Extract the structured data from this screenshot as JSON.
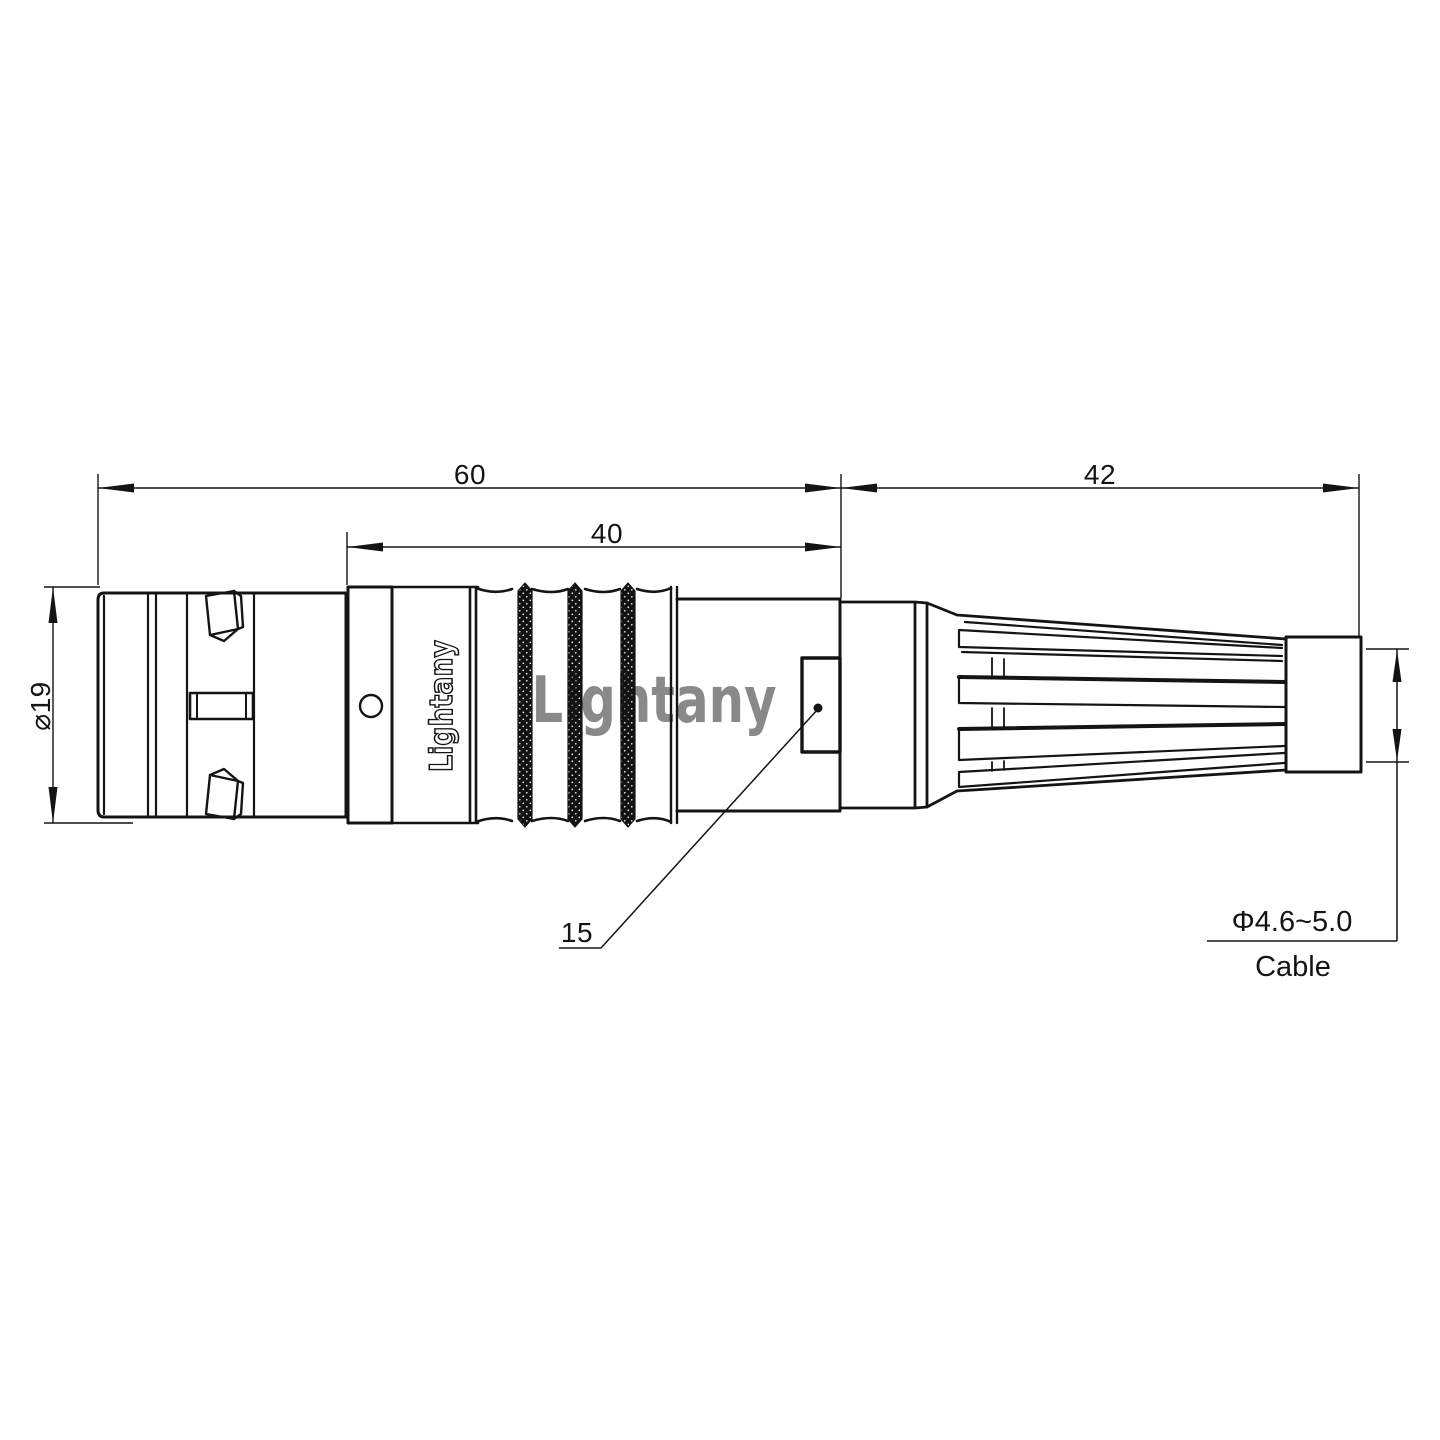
{
  "page": {
    "background": "#ffffff",
    "line_color": "#141414",
    "description": "Technical dimension drawing of a push-pull circular cable connector with strain relief boot"
  },
  "watermark": {
    "text": "Lightany",
    "color": "#e89f9f"
  },
  "connector": {
    "brand_label": "Lightany"
  },
  "dimensions": {
    "total_length": "60",
    "front_length": "40",
    "rear_length": "42",
    "shell_diameter": "⌀19",
    "nut_size": "15",
    "cable_diameter": "Φ4.6~5.0",
    "cable_label": "Cable"
  }
}
